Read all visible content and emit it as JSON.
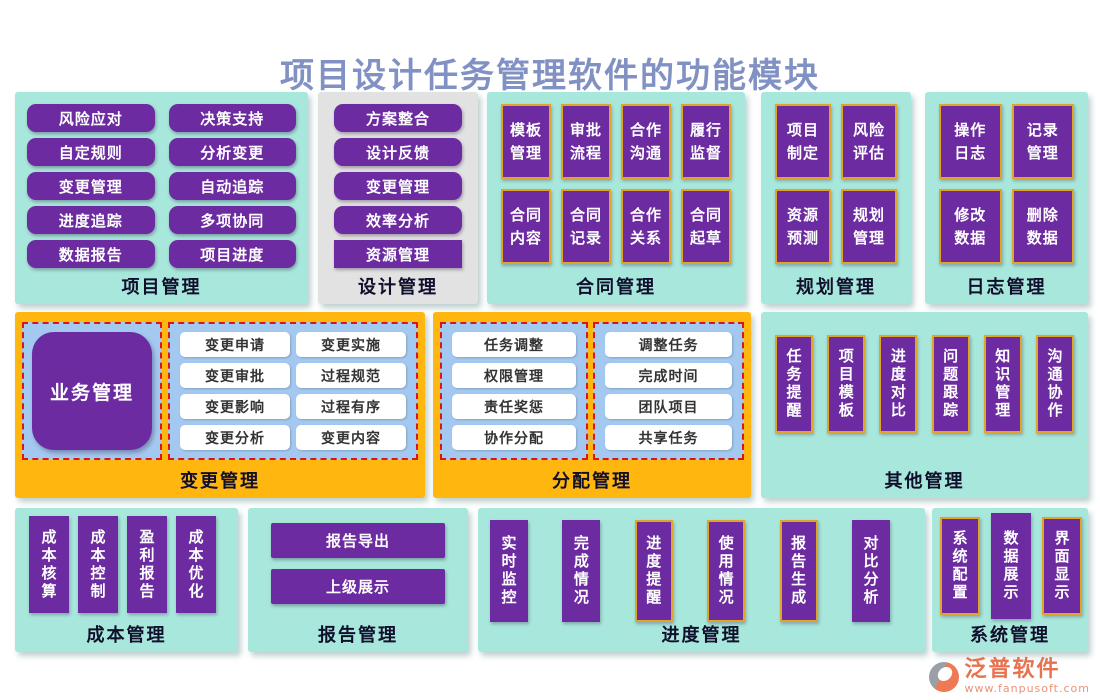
{
  "title": "项目设计任务管理软件的功能模块",
  "colors": {
    "teal_panel": "#A8E7DB",
    "gray_panel": "#E2E2E2",
    "orange_panel": "#FFB60F",
    "module_purple": "#6C2BA0",
    "light_blue_sub": "#A4C9F1",
    "red_dashed_border": "#DE1515",
    "gold_border": "#E2A426",
    "title_text": "#8191C4",
    "logo_coral": "#E8714E"
  },
  "panels": {
    "project": {
      "label": "项目管理",
      "buttons": [
        "风险应对",
        "决策支持",
        "自定规则",
        "分析变更",
        "变更管理",
        "自动追踪",
        "进度追踪",
        "多项协同",
        "数据报告",
        "项目进度"
      ]
    },
    "design": {
      "label": "设计管理",
      "buttons": [
        "方案整合",
        "设计反馈",
        "变更管理",
        "效率分析",
        "资源管理"
      ]
    },
    "contract": {
      "label": "合同管理",
      "buttons": [
        "模板\n管理",
        "审批\n流程",
        "合作\n沟通",
        "履行\n监督",
        "合同\n内容",
        "合同\n记录",
        "合作\n关系",
        "合同\n起草"
      ]
    },
    "planning": {
      "label": "规划管理",
      "buttons": [
        "项目\n制定",
        "风险\n评估",
        "资源\n预测",
        "规划\n管理"
      ]
    },
    "log": {
      "label": "日志管理",
      "buttons": [
        "操作\n日志",
        "记录\n管理",
        "修改\n数据",
        "删除\n数据"
      ]
    },
    "change": {
      "label": "变更管理",
      "hub": "业务管理",
      "buttons": [
        "变更申请",
        "变更实施",
        "变更审批",
        "过程规范",
        "变更影响",
        "过程有序",
        "变更分析",
        "变更内容"
      ]
    },
    "allocation": {
      "label": "分配管理",
      "left_buttons": [
        "任务调整",
        "权限管理",
        "责任奖惩",
        "协作分配"
      ],
      "right_buttons": [
        "调整任务",
        "完成时间",
        "团队项目",
        "共享任务"
      ]
    },
    "other": {
      "label": "其他管理",
      "buttons": [
        "任务提醒",
        "项目模板",
        "进度对比",
        "问题跟踪",
        "知识管理",
        "沟通协作"
      ]
    },
    "cost": {
      "label": "成本管理",
      "buttons": [
        "成本核算",
        "成本控制",
        "盈利报告",
        "成本优化"
      ]
    },
    "report": {
      "label": "报告管理",
      "buttons": [
        "报告导出",
        "上级展示"
      ]
    },
    "progress": {
      "label": "进度管理",
      "buttons": [
        "实时监控",
        "完成情况",
        "进度提醒",
        "使用情况",
        "报告生成",
        "对比分析"
      ]
    },
    "system": {
      "label": "系统管理",
      "buttons": [
        "系统配置",
        "数据展示",
        "界面显示"
      ]
    }
  },
  "watermark": {
    "text": "泛普软件",
    "subtext": "FANPU SOFTWARE"
  },
  "logo": {
    "name": "泛普软件",
    "url": "www.fanpusoft.com"
  }
}
